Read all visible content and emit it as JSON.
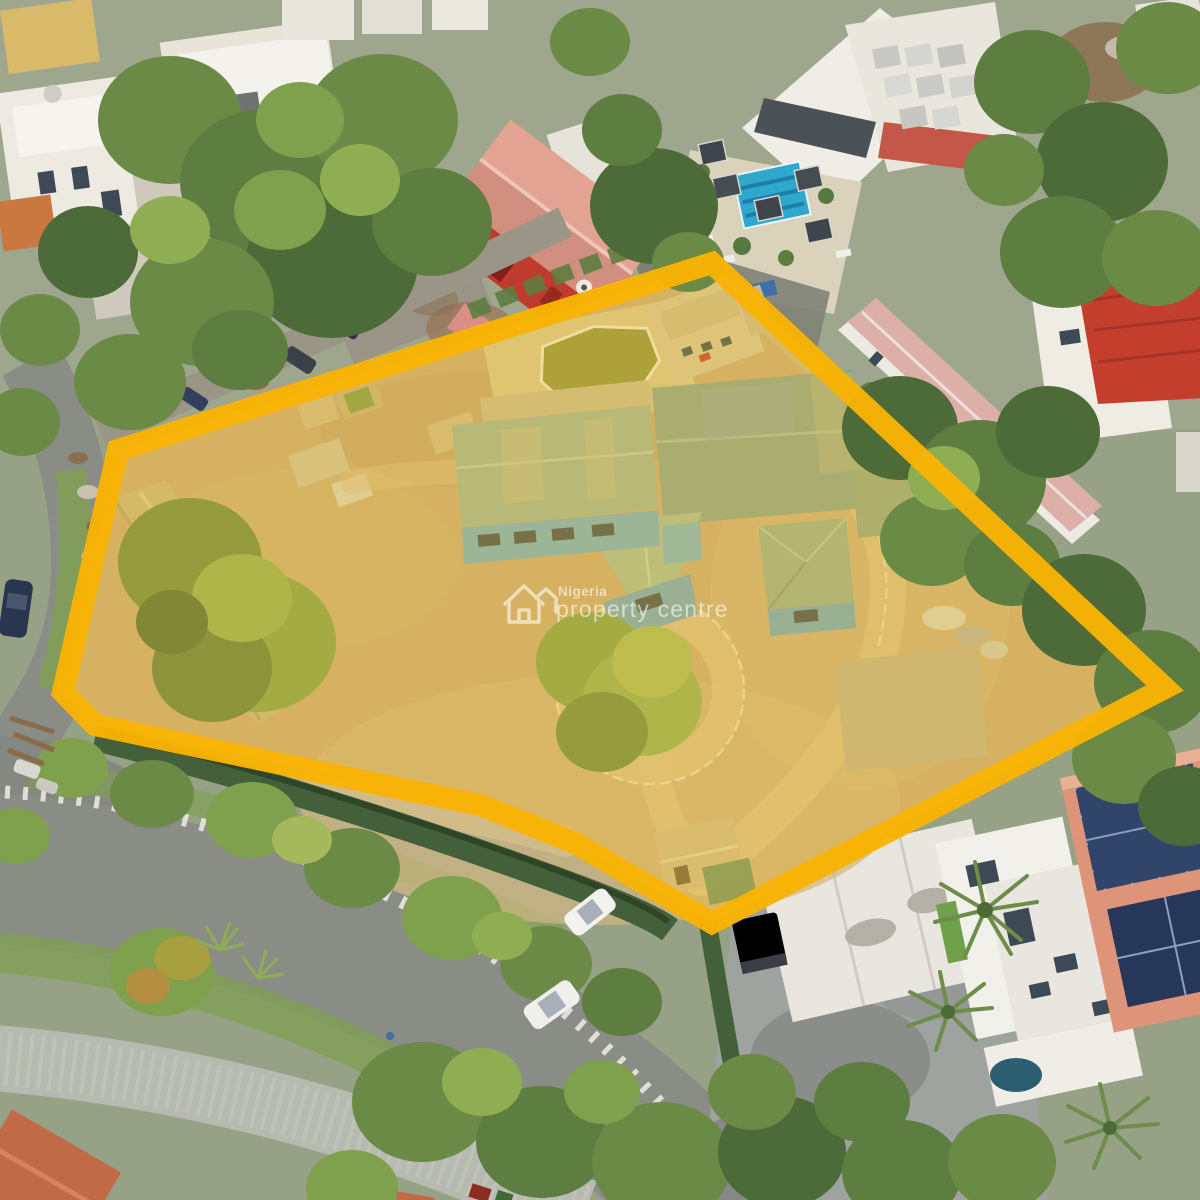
{
  "watermark": {
    "brand_line1": "Nigeria",
    "brand_line2": "property centre",
    "icon": "house-icon"
  },
  "boundary": {
    "shape": "polygon",
    "points_str": "118,450 712,263 1165,688 712,923 575,843 480,805 300,768 95,725 63,692",
    "stroke_width": 22
  },
  "palette": {
    "boundary_yellow": "#f8b303",
    "tint_rgba": "rgba(244,196,48,0.32)",
    "sand": "#c8a97a",
    "sand_light": "#d8c08c",
    "roof_teal": "#9db49a",
    "roof_teal_dark": "#87a38f",
    "wall_blue": "#6fa9c4",
    "pool_blue": "#2fa8ce",
    "empty_pool_olive": "#8e9140",
    "road_gray": "#8a8c86",
    "paver_gray": "#b7bab0",
    "roof_red": "#c43e2e",
    "barn_salmon": "#e2a392",
    "roof_terracotta": "#c06a48",
    "roof_pink": "#dcafa8",
    "solar_navy": "#31456b",
    "vegetation": "#6b8a46",
    "watermark_white": "#ffffff"
  },
  "scene": {
    "type": "aerial-drone-photo",
    "subject": "highlighted-land-parcel-with-derelict-building",
    "objects": [
      "yellow-boundary-outline",
      "golden-parcel-tint",
      "main-derelict-building",
      "empty-swimming-pool",
      "compound-outbuilding",
      "compound-trees",
      "circular-driveway",
      "hotel-with-rooftop-pool",
      "red-warehouse",
      "white-residences",
      "pink-roof-barracks",
      "solar-roof-villa",
      "white-canopy",
      "curved-street",
      "lane-markings",
      "hatched-curb",
      "parked-cars",
      "street-trees",
      "paver-sidewalk",
      "terracotta-roofs",
      "palm-trees"
    ]
  }
}
